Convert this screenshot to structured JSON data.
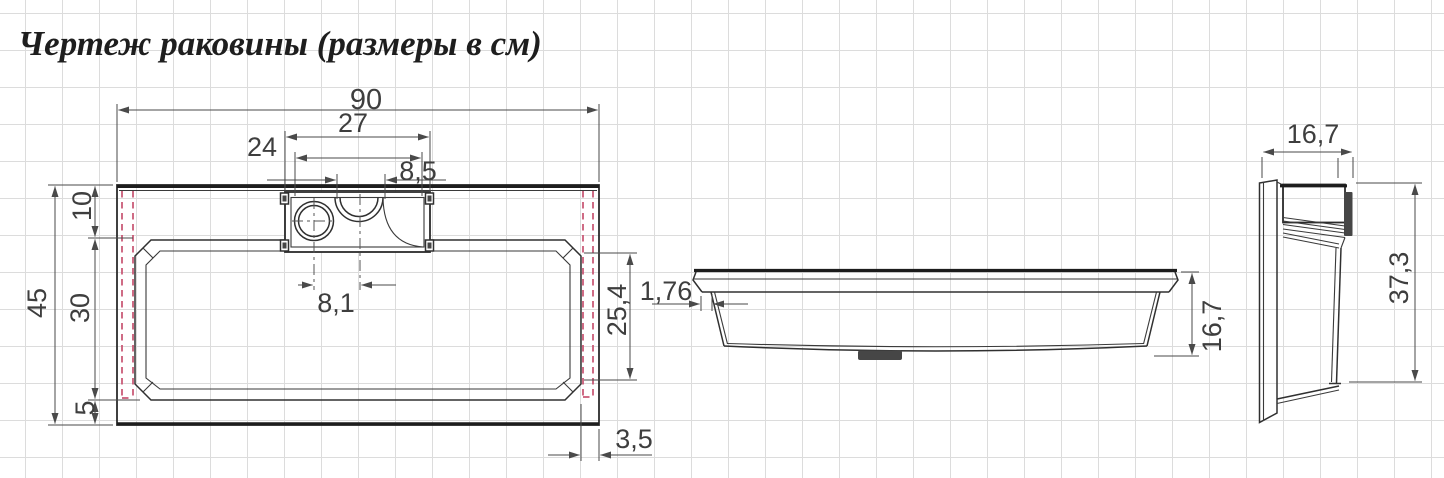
{
  "title": "Чертеж раковины (размеры в см)",
  "dimensions": {
    "top_view": {
      "overall_width": "90",
      "deck_width": "27",
      "deck_inner_width": "24",
      "cutout_width": "8,5",
      "hole_to_cutout": "8,1",
      "rim_top_depth": "10",
      "basin_depth": "30",
      "rim_bottom_depth": "5",
      "overall_depth": "45",
      "basin_inner_depth": "25,4",
      "edge_gap": "3,5"
    },
    "front_view": {
      "wall_thickness": "1,76",
      "height": "16,7"
    },
    "side_view": {
      "depth": "16,7",
      "height": "37,3"
    }
  },
  "colors": {
    "line": "#2b2b2b",
    "dimension": "#4a4a4a",
    "hidden_line_red": "#c75270",
    "grid": "#dcdcdc",
    "background": "#ffffff"
  }
}
